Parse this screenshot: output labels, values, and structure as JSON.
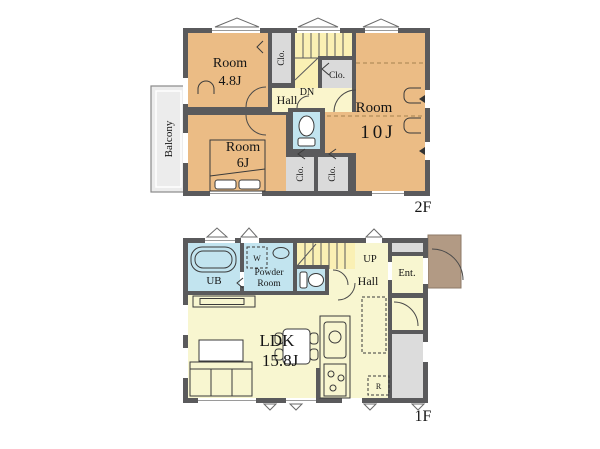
{
  "colors": {
    "wall": "#5a5a5c",
    "room_orange": "#ebbc85",
    "hall_yellow": "#faf5cc",
    "stairs_yellow": "#faf0b4",
    "ldk_yellow": "#f8f6d0",
    "wet_blue": "#c2e4ef",
    "closet_gray": "#dadada",
    "balcony_gray": "#ececec",
    "porch_brown": "#b29a84",
    "service_gray": "#dcdcdc"
  },
  "floor2": {
    "floor_label": "2F",
    "room48_name": "Room",
    "room48_size": "4.8J",
    "room10_name": "Room",
    "room10_size": "10J",
    "room6_name": "Room",
    "room6_size": "6J",
    "hall": "Hall",
    "dn": "DN",
    "balcony": "Balcony",
    "closet_top": "Clo.",
    "closet_mid": "Clo.",
    "closet_bottom_left": "Clo.",
    "closet_bottom_right": "Clo."
  },
  "floor1": {
    "floor_label": "1F",
    "ub": "UB",
    "powder_line1": "Powder",
    "powder_line2": "Room",
    "washer": "W",
    "up": "UP",
    "hall": "Hall",
    "entrance": "Ent.",
    "ldk_name": "LDK",
    "ldk_size": "15.8J",
    "refrigerator": "R"
  }
}
